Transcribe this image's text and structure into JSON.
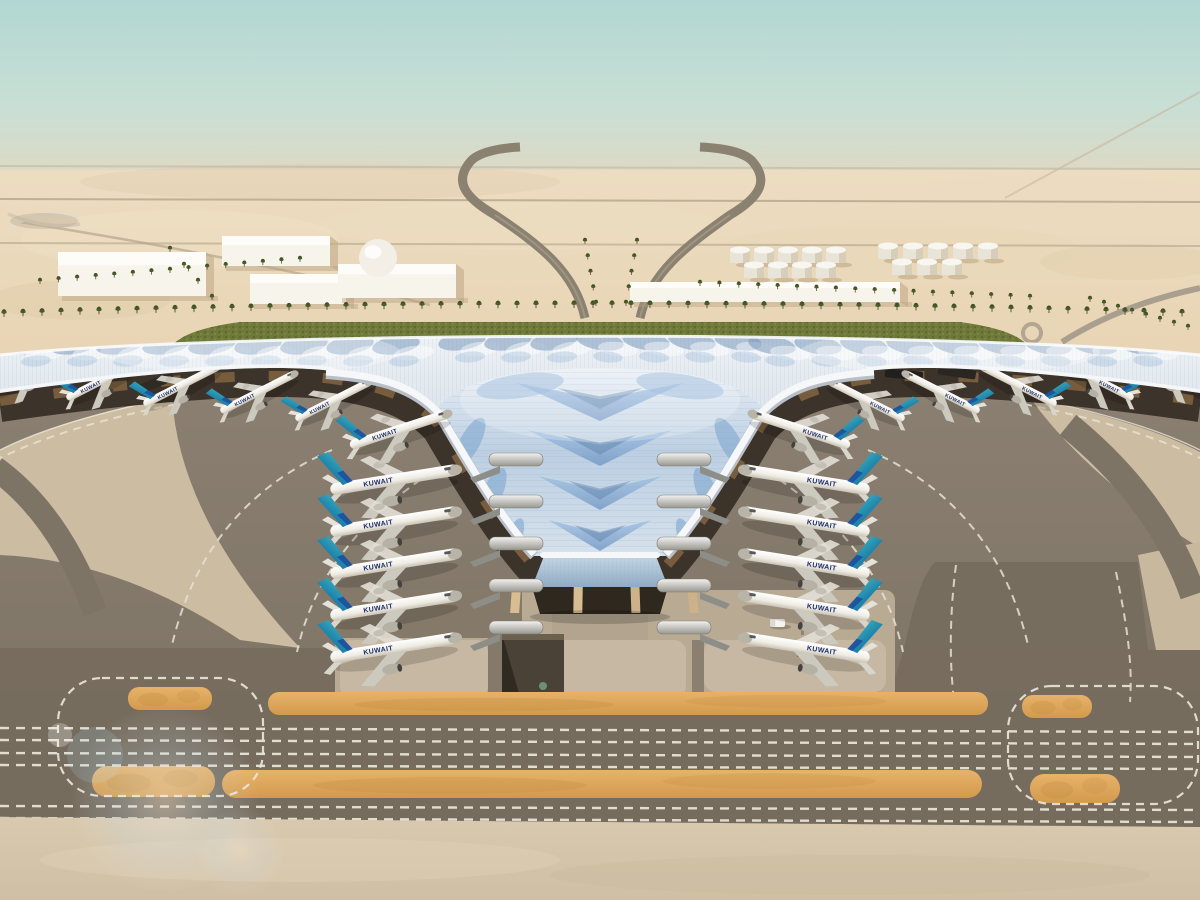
{
  "meta": {
    "title": "Aerial rendering of Kuwait International Airport trefoil terminal",
    "scene": "desert airport rendering, no UI chrome, no on-screen text except aircraft livery"
  },
  "airline": {
    "title": "KUWAIT"
  },
  "colors": {
    "sky_top": "#b2d7d2",
    "sky_mid": "#c9dfd5",
    "horizon": "#e6d8be",
    "desert": "#e7d2b0",
    "desert_light": "#f0e1c6",
    "desert_dark": "#dcc6a2",
    "green_strip": "#6e793a",
    "green_dark": "#55622c",
    "palm": "#3e5022",
    "road": "#8a8170",
    "apron_top": "#8b8071",
    "apron_bottom": "#7b7163",
    "band": "#766c5d",
    "sand_taxi": "#cdbda2",
    "concrete_fg": "#d7c7ad",
    "orange": "#dca558",
    "orange_hi": "#e7b26a",
    "roof_hi": "#eef2f6",
    "roof_mid": "#cfd8e2",
    "funnel_top": "#e8eef5",
    "funnel_mid": "#aec4dc",
    "funnel_low": "#d6e1ec",
    "chevron": "#86aed8",
    "chevron_dark": "#5e80a8",
    "fascia_white": "#f5f7f8",
    "shadow_band": "#3c332a",
    "bronze": "#a87f4f",
    "tail_teal": "#45b8b8",
    "tail_blue": "#1e81a8",
    "tail_navy": "#1d4f9c",
    "fuselage": "#f6f4ee",
    "glass": "#a3bdd3",
    "tunnel": "#4a4237",
    "dash_white": "#ece7db",
    "building_white": "#f7f4ec"
  },
  "background": {
    "horizon_lines": [
      {
        "y": 166,
        "o": 0.4
      },
      {
        "y": 199,
        "o": 0.8
      },
      {
        "y": 243,
        "o": 0.6
      }
    ],
    "buildings": [
      {
        "x": 58,
        "y": 252,
        "w": 148,
        "h": 44
      },
      {
        "x": 222,
        "y": 236,
        "w": 108,
        "h": 30
      },
      {
        "x": 250,
        "y": 274,
        "w": 96,
        "h": 30
      },
      {
        "x": 338,
        "y": 264,
        "w": 118,
        "h": 34,
        "dome": {
          "cx": 378,
          "cy": 258,
          "r": 19
        }
      },
      {
        "x": 630,
        "y": 282,
        "w": 270,
        "h": 20
      },
      {
        "x": 938,
        "y": 328,
        "w": 26,
        "h": 13
      }
    ],
    "tank_rows": [
      {
        "x0": 740,
        "y": 250,
        "n": 5,
        "dx": 24
      },
      {
        "x0": 754,
        "y": 265,
        "n": 4,
        "dx": 24
      },
      {
        "x0": 888,
        "y": 246,
        "n": 5,
        "dx": 25
      },
      {
        "x0": 902,
        "y": 262,
        "n": 3,
        "dx": 25
      }
    ],
    "palm_main_row": {
      "x0": 4,
      "x1": 1196,
      "step": 19,
      "base_y": 308,
      "bow": 9
    },
    "palm_rows": [
      {
        "x1": 40,
        "y1": 284,
        "x2": 300,
        "y2": 262,
        "n": 15
      },
      {
        "x1": 700,
        "y1": 286,
        "x2": 1030,
        "y2": 300,
        "n": 18
      },
      {
        "x1": 596,
        "y1": 306,
        "x2": 585,
        "y2": 244,
        "n": 5
      },
      {
        "x1": 626,
        "y1": 306,
        "x2": 637,
        "y2": 244,
        "n": 5
      },
      {
        "x1": 1090,
        "y1": 302,
        "x2": 1188,
        "y2": 330,
        "n": 8
      },
      {
        "x1": 170,
        "y1": 252,
        "x2": 212,
        "y2": 300,
        "n": 4
      }
    ]
  },
  "terminal": {
    "chevrons": [
      {
        "y": 383,
        "w": 168,
        "h": 38
      },
      {
        "y": 430,
        "w": 146,
        "h": 36
      },
      {
        "y": 476,
        "w": 124,
        "h": 34
      },
      {
        "y": 520,
        "w": 104,
        "h": 31
      },
      {
        "y": 562,
        "w": 86,
        "h": 28
      },
      {
        "y": 602,
        "w": 70,
        "h": 25
      },
      {
        "y": 640,
        "w": 56,
        "h": 21
      },
      {
        "y": 676,
        "w": 44,
        "h": 17
      },
      {
        "y": 708,
        "w": 33,
        "h": 13
      },
      {
        "y": 736,
        "w": 24,
        "h": 10
      }
    ],
    "side_leaves": [
      {
        "x": 470,
        "y": 442,
        "rx": 27,
        "ry": 10,
        "a": -62
      },
      {
        "x": 492,
        "y": 494,
        "rx": 28,
        "ry": 10,
        "a": -66
      },
      {
        "x": 513,
        "y": 541,
        "rx": 24,
        "ry": 8,
        "a": -70
      }
    ],
    "upper_patches": [
      {
        "x": 520,
        "y": 386,
        "rx": 44,
        "ry": 12,
        "a": -8
      },
      {
        "x": 680,
        "y": 386,
        "rx": 44,
        "ry": 12,
        "a": 8
      }
    ],
    "fans": [
      {
        "x0": 28,
        "x1": 430,
        "step": 46,
        "y": 341
      },
      {
        "x0": 462,
        "x1": 738,
        "step": 46,
        "y": 337
      },
      {
        "x0": 772,
        "x1": 1174,
        "step": 46,
        "y": 341
      }
    ]
  },
  "aircraft": {
    "v_left": {
      "x": 392,
      "dir": 1,
      "angle": -9,
      "scale": 1.3,
      "ys": [
        480,
        522,
        564,
        606,
        648
      ]
    },
    "v_right": {
      "x": 808,
      "dir": -1,
      "angle": 9,
      "scale": 1.3,
      "ys": [
        480,
        522,
        564,
        606,
        648
      ]
    },
    "wing_left": {
      "dir": 1,
      "angle": -27,
      "scale": 0.85,
      "pts": [
        [
          26,
          374
        ],
        [
          103,
          380
        ],
        [
          180,
          386
        ],
        [
          257,
          393
        ],
        [
          332,
          401
        ]
      ]
    },
    "wing_right": {
      "dir": -1,
      "angle": 27,
      "scale": 0.85,
      "pts": [
        [
          1174,
          374
        ],
        [
          1097,
          380
        ],
        [
          1020,
          386
        ],
        [
          943,
          393
        ],
        [
          868,
          401
        ]
      ]
    },
    "transitional": [
      {
        "x": 398,
        "y": 430,
        "angle": -18,
        "scale": 1.05,
        "dir": 1
      },
      {
        "x": 802,
        "y": 430,
        "angle": 18,
        "scale": 1.05,
        "dir": -1
      }
    ],
    "pods_left_x": 489,
    "pods_right_x": 657
  },
  "ground": {
    "orange_strips": [
      {
        "x": 268,
        "y": 692,
        "w": 720,
        "h": 23,
        "rx": 11
      },
      {
        "x": 128,
        "y": 687,
        "w": 84,
        "h": 23,
        "rx": 11
      },
      {
        "x": 1022,
        "y": 695,
        "w": 70,
        "h": 23,
        "rx": 11
      },
      {
        "x": 222,
        "y": 770,
        "w": 760,
        "h": 28,
        "rx": 14
      },
      {
        "x": 92,
        "y": 766,
        "w": 123,
        "h": 31,
        "rx": 15
      },
      {
        "x": 1030,
        "y": 774,
        "w": 90,
        "h": 29,
        "rx": 14
      }
    ],
    "dash_rows": [
      728,
      740,
      753,
      765,
      806,
      818
    ],
    "junction_ovals": [
      {
        "x": 58,
        "y": 678,
        "w": 205,
        "h": 118,
        "r": 44
      },
      {
        "x": 1008,
        "y": 686,
        "w": 190,
        "h": 118,
        "r": 44
      }
    ],
    "vehicles": {
      "van": {
        "x": 770,
        "y": 619,
        "w": 15,
        "h": 8
      },
      "bollards": [
        [
          801,
          626
        ],
        [
          797,
          648
        ]
      ]
    }
  }
}
